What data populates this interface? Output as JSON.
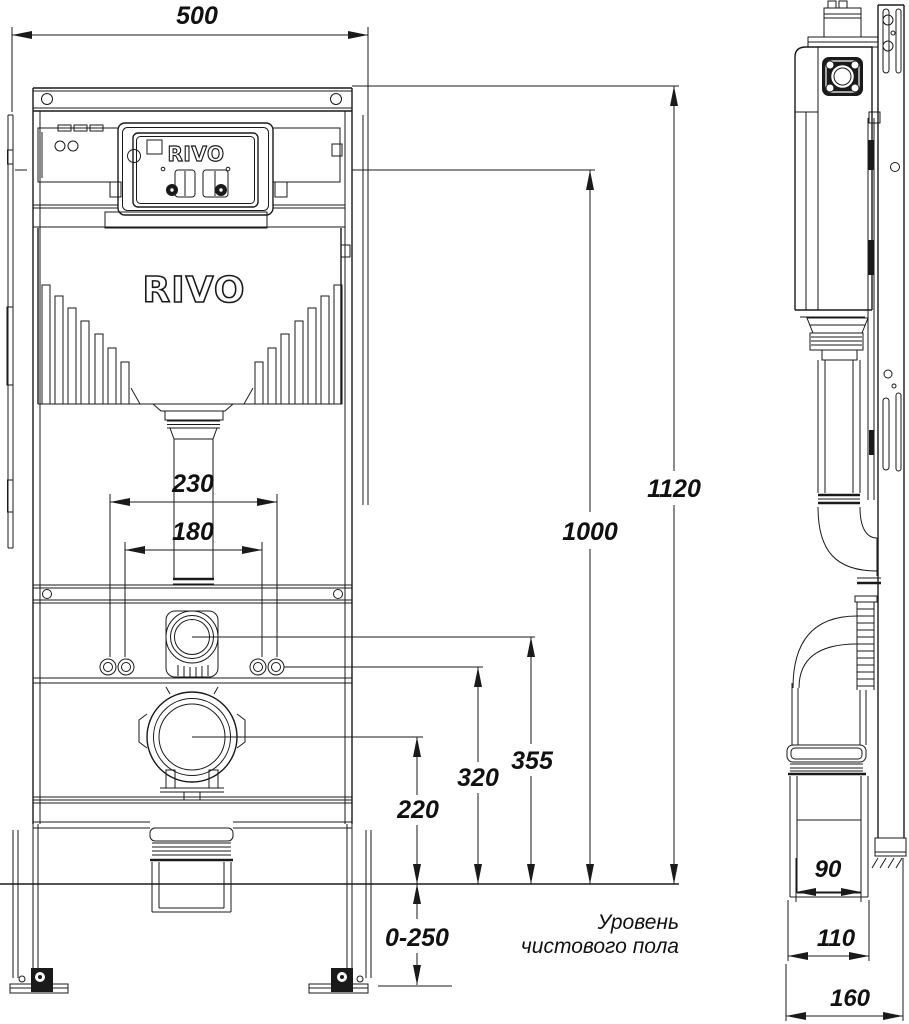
{
  "brand": "RIVO",
  "front_view": {
    "dim_width": "500",
    "dim_total_height": "1120",
    "dim_panel_height": "1000",
    "dim_studs_outer": "230",
    "dim_studs_inner": "180",
    "dim_flush_center_height": "355",
    "dim_studs_height": "320",
    "dim_waste_center_height": "220",
    "dim_leg_adjustment": "0-250",
    "floor_label_line1": "Уровень",
    "floor_label_line2": "чистового пола"
  },
  "side_view": {
    "dim_outlet_90": "90",
    "dim_pipe_110": "110",
    "dim_depth_160": "160"
  },
  "colors": {
    "line": "#1a1a1a",
    "background": "#ffffff"
  }
}
